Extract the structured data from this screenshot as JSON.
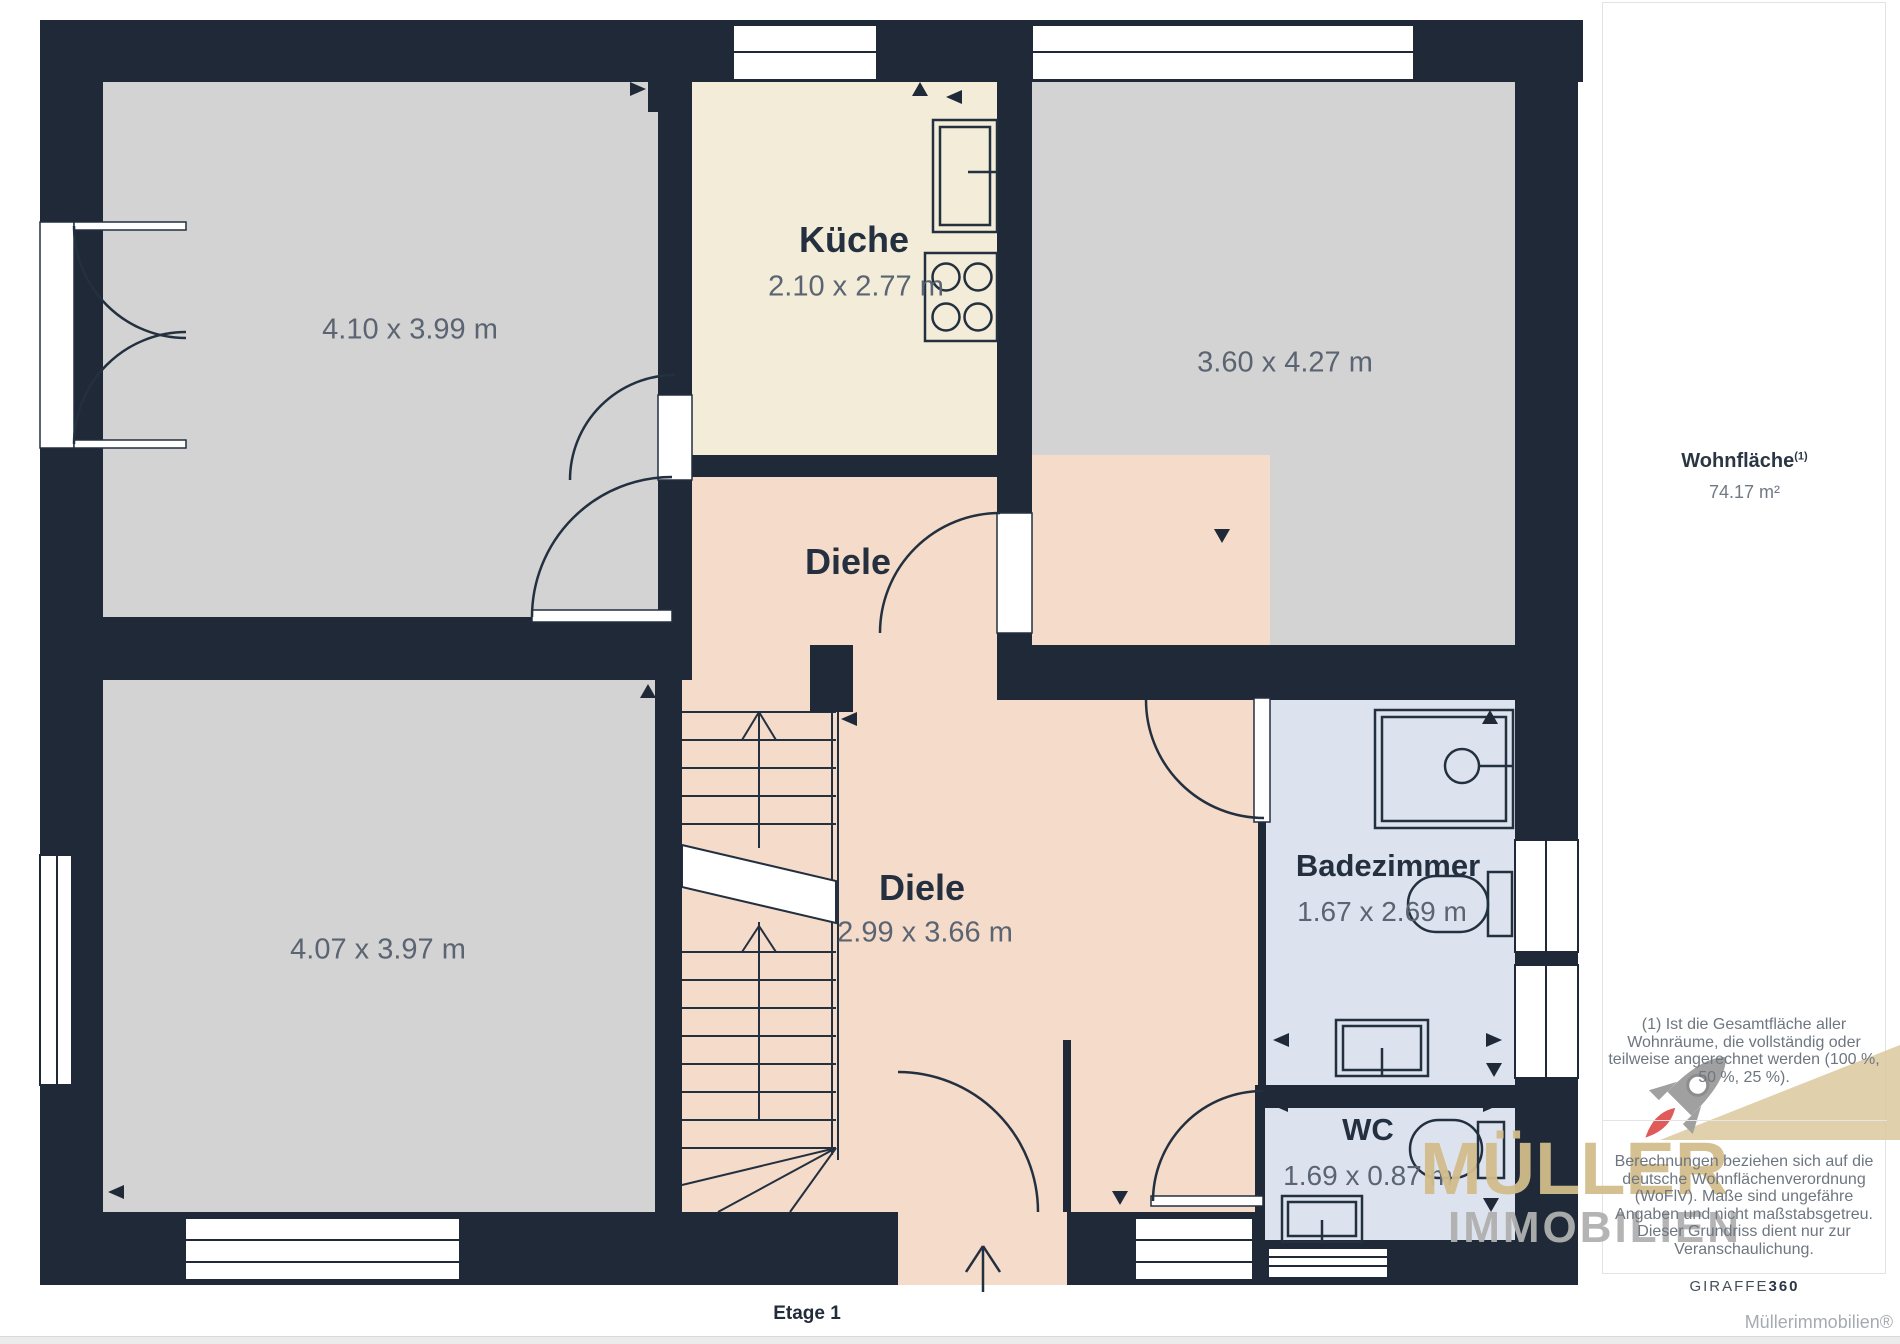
{
  "floorplan": {
    "floor_label": "Etage 1",
    "rooms": {
      "top_left": {
        "dims": "4.10 x 3.99 m"
      },
      "kueche": {
        "name": "Küche",
        "dims": "2.10 x 2.77 m"
      },
      "top_right": {
        "dims": "3.60 x 4.27 m"
      },
      "diele_upper": {
        "name": "Diele"
      },
      "diele_main": {
        "name": "Diele",
        "dims": "2.99 x 3.66 m"
      },
      "bottom_left": {
        "dims": "4.07 x 3.97 m"
      },
      "badezimmer": {
        "name": "Badezimmer",
        "dims": "1.67 x 2.69 m"
      },
      "wc": {
        "name": "WC",
        "dims": "1.69 x 0.87 m"
      }
    }
  },
  "sidebar": {
    "area_label": "Wohnfläche",
    "area_superscript": "(1)",
    "area_value": "74.17 m²",
    "footnote_1": "(1) Ist die Gesamtfläche aller Wohnräume, die vollständig oder teilweise angerechnet werden (100 %, 50 %, 25 %).",
    "footnote_2": "Berechnungen beziehen sich auf die deutsche Wohnflächenverordnung (WoFlV). Maße sind ungefähre Angaben und nicht maßstabsgetreu. Dieser Grundriss dient nur zur Veranschaulichung.",
    "brand_giraffe": "GIRAFFE",
    "brand_giraffe_bold": "360",
    "credit": "Müllerimmobilien®"
  },
  "watermark": {
    "rocket_icon": "rocket-icon",
    "line1": "MÜLLER",
    "line2": "IMMOBILIEN"
  },
  "colors": {
    "wall": "#1f2937",
    "room_gray": "#d3d3d3",
    "room_cream": "#f2ecd8",
    "room_pink": "#f5dbc9",
    "room_blue": "#dde3ee",
    "dim_text": "#5b6472",
    "name_text": "#243040",
    "watermark_tan": "#d2bd8b",
    "watermark_gray": "#b0b0b0",
    "flame_red": "#e05a5a"
  }
}
